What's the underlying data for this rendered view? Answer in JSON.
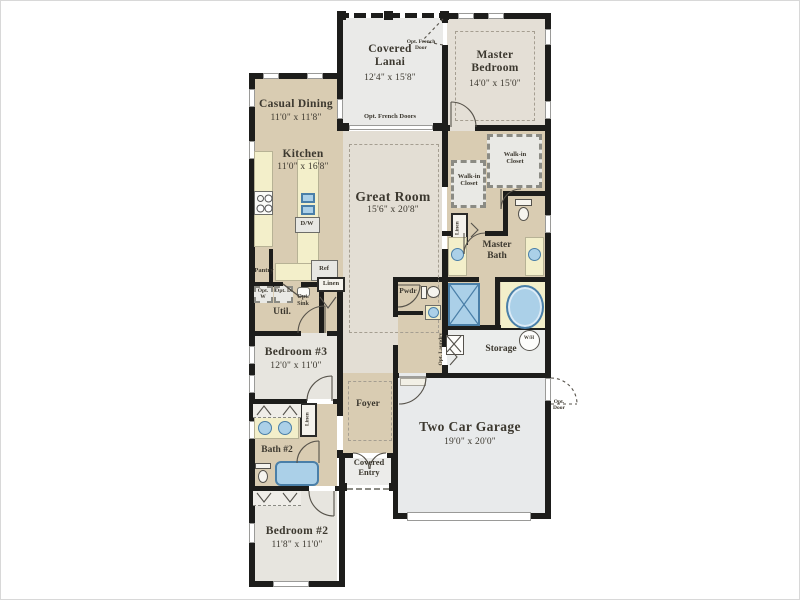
{
  "plan_type": "single-story residential floor plan",
  "colors": {
    "wall": "#1d1d1b",
    "tan_floor": "#d9ccb2",
    "beige_floor": "#e3ded4",
    "bedroom_floor": "#e7e5df",
    "lanai_floor": "#eaeae8",
    "garage_floor": "#e8eaeb",
    "counter": "#f3efca",
    "fixture_blue": "#abd0e8",
    "fixture_border": "#4a7fa8",
    "text": "#3c382f"
  },
  "rooms": {
    "casual_dining": {
      "name": "Casual Dining",
      "dims": "11'0\" x 11'8\""
    },
    "kitchen": {
      "name": "Kitchen",
      "dims": "11'0\" x 16'8\""
    },
    "covered_lanai": {
      "name": "Covered Lanai",
      "dims": "12'4\" x 15'8\""
    },
    "master_bedroom": {
      "name": "Master Bedroom",
      "dims": "14'0\" x 15'0\""
    },
    "great_room": {
      "name": "Great Room",
      "dims": "15'6\" x 20'8\""
    },
    "bedroom3": {
      "name": "Bedroom #3",
      "dims": "12'0\" x 11'0\""
    },
    "bedroom2": {
      "name": "Bedroom #2",
      "dims": "11'8\" x 11'0\""
    },
    "garage": {
      "name": "Two Car Garage",
      "dims": "19'0\" x 20'0\""
    },
    "foyer": {
      "name": "Foyer"
    },
    "covered_entry": {
      "name": "Covered Entry"
    },
    "storage": {
      "name": "Storage"
    },
    "util": {
      "name": "Util."
    },
    "pwdr": {
      "name": "Pwdr"
    },
    "master_bath": {
      "name": "Master Bath"
    },
    "bath2": {
      "name": "Bath #2"
    },
    "walk_in_closet": {
      "name": "Walk-in Closet"
    },
    "pantry": {
      "name": "Pantry"
    },
    "linen": {
      "name": "Linen"
    }
  },
  "annotations": {
    "opt_french_doors": "Opt. French Doors",
    "opt_french_door": "Opt. French Door",
    "opt_door": "Opt. Door",
    "opt_laundry": "Opt. Laundry",
    "opt_sink": "Opt. Sink",
    "opt_w": "Opt. W",
    "opt_d": "Opt. D",
    "dw": "D/W",
    "ref": "Ref",
    "wh": "W/H"
  }
}
